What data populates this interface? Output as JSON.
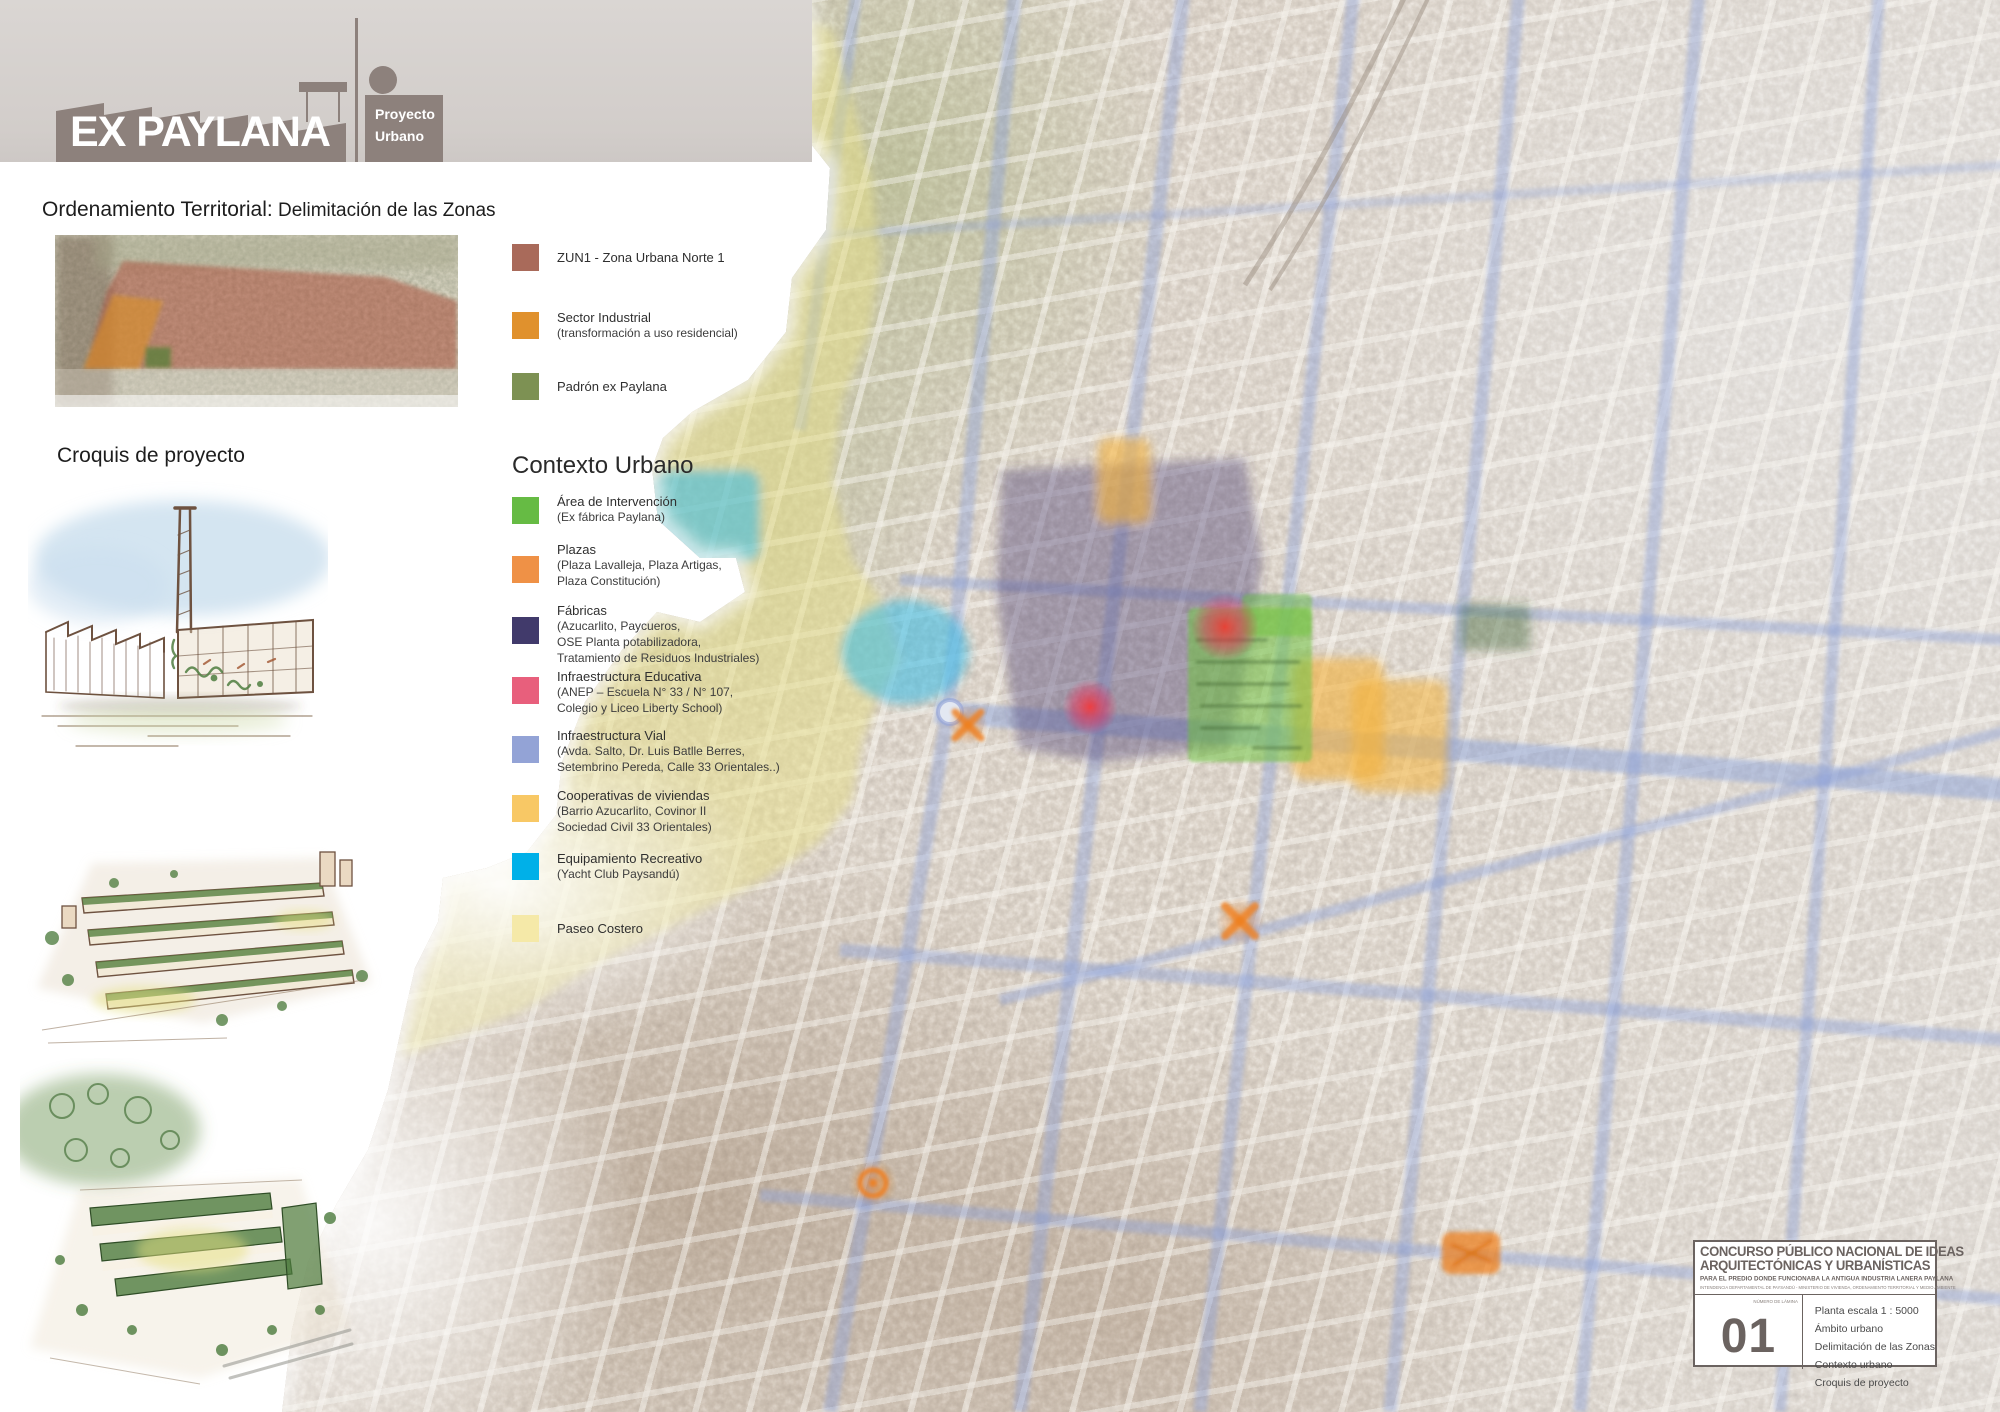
{
  "logo": {
    "title": "EX PAYLANA",
    "subtitle_line1": "Proyecto",
    "subtitle_line2": "Urbano",
    "brand_color": "#8d817c"
  },
  "sections": {
    "ordenamiento_heading_strong": "Ordenamiento Territorial:",
    "ordenamiento_heading_rest": " Delimitación de las Zonas",
    "croquis_heading": "Croquis de proyecto",
    "contexto_heading": "Contexto Urbano"
  },
  "zonas_legend": [
    {
      "label": "ZUN1 - Zona Urbana Norte 1",
      "color": "#a96a5a"
    },
    {
      "label": "Sector Industrial",
      "subline": "(transformación a uso residencial)",
      "color": "#e0912d"
    },
    {
      "label": "Padrón ex Paylana",
      "color": "#7d9153"
    }
  ],
  "contexto_legend": [
    {
      "label": "Área  de Intervención",
      "sublines": [
        "(Ex fábrica Paylana)"
      ],
      "color": "#66bb44"
    },
    {
      "label": "Plazas",
      "sublines": [
        "(Plaza Lavalleja, Plaza Artigas,",
        "Plaza Constitución)"
      ],
      "color": "#ef9146"
    },
    {
      "label": "Fábricas",
      "sublines": [
        "(Azucarlito, Paycueros,",
        "OSE Planta potabilizadora,",
        "Tratamiento de Residuos Industriales)"
      ],
      "color": "#413a6b"
    },
    {
      "label": "Infraestructura Educativa",
      "sublines": [
        "(ANEP – Escuela N° 33 / N° 107,",
        "Colegio y Liceo Liberty School)"
      ],
      "color": "#e85f7c"
    },
    {
      "label": "Infraestructura Vial",
      "sublines": [
        "(Avda. Salto,  Dr. Luis Batlle Berres,",
        "Setembrino Pereda, Calle 33 Orientales..)"
      ],
      "color": "#93a3d6"
    },
    {
      "label": "Cooperativas de viviendas",
      "sublines": [
        "(Barrio Azucarlito, Covinor II",
        "Sociedad Civil 33 Orientales)"
      ],
      "color": "#f8c865"
    },
    {
      "label": "Equipamiento Recreativo",
      "sublines": [
        "(Yacht Club  Paysandú)"
      ],
      "color": "#00b0e8"
    },
    {
      "label": "Paseo Costero",
      "sublines": [],
      "color": "#f5e9a8"
    }
  ],
  "map_overlay_colors": {
    "vial_roads": "#8aa0d8",
    "plaza_markers": "#ef7f1f",
    "educativa_markers": "#e8305a",
    "fabricas_zone": "#4a4276",
    "intervencion_zone": "#6fc13e",
    "cooperativas_zone": "#f4b33c",
    "recreativo_zone": "#35bbe8",
    "paseo_costero_zone": "#e9e28a"
  },
  "title_block": {
    "title_line1": "CONCURSO PÚBLICO NACIONAL DE IDEAS",
    "title_line2": "ARQUITECTÓNICAS Y URBANÍSTICAS",
    "subtitle": "PARA EL PREDIO DONDE FUNCIONABA LA ANTIGUA INDUSTRIA LANERA PAYLANA",
    "org_line": "INTENDENCIA DEPARTAMENTAL DE PAYSANDÚ - MINISTERIO DE VIVIENDA, ORDENAMIENTO TERRITORIAL Y MEDIO AMBIENTE",
    "sheet_label": "NÚMERO DE LÁMINA",
    "sheet_number": "01",
    "contents": [
      "Planta escala 1 : 5000",
      "Ámbito urbano",
      "Delimitación de las Zonas",
      "Contexto urbano",
      "Croquis de proyecto"
    ]
  }
}
